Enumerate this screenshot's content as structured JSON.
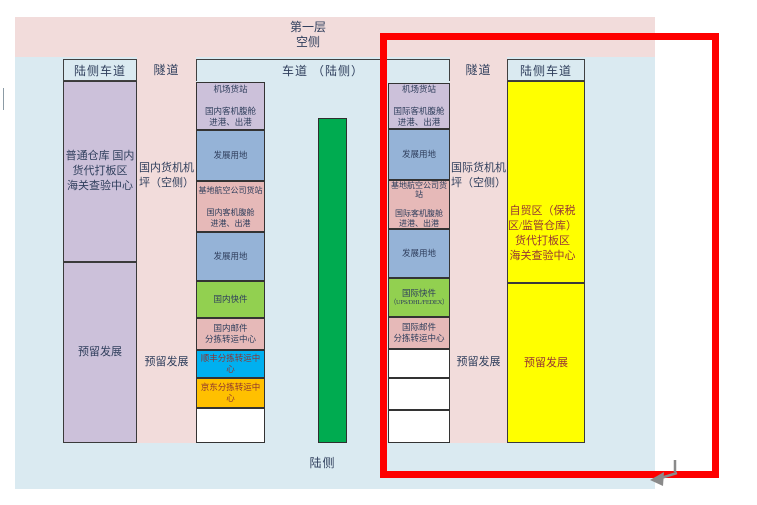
{
  "palette": {
    "banner_pink": "#F2DCDB",
    "bg_blue": "#DAEAF1",
    "highlight_red": "#FE0000",
    "green_bar": "#00AB50"
  },
  "title": "第一层\n空侧",
  "headers": {
    "left_lane": "陆侧车道",
    "tunnel_left": "隧道",
    "center_lane": "车道 （陆侧）",
    "tunnel_right": "隧道",
    "right_lane": "陆侧车道"
  },
  "bottom_label": "陆侧",
  "left_column": {
    "top": {
      "label": "普通仓库 国内\n货代打板区\n海关查验中心",
      "color": "#CCC1DA",
      "text_color": "#2F3E5C"
    },
    "bottom": {
      "label": "预留发展",
      "color": "#CCC1DA",
      "text_color": "#2F3E5C"
    }
  },
  "tunnel_left_zone": {
    "apron": "国内货机机\n坪（空侧）",
    "reserved": "预留发展"
  },
  "tunnel_right_zone": {
    "apron": "国际货机机\n坪（空侧）",
    "reserved": "预留发展"
  },
  "domestic_stack": {
    "blocks": [
      {
        "label": "机场货站\n\n国内客机腹舱\n进港、出港",
        "color": "#CCC1DA",
        "text_color": "#2F3E5C"
      },
      {
        "label": "发展用地",
        "color": "#95B3D7",
        "text_color": "#2F3E5C"
      },
      {
        "label": "基地航空公司货站\n\n国内客机腹舱\n进港、出港",
        "color": "#E6B9B8",
        "text_color": "#2F3E5C"
      },
      {
        "label": "发展用地",
        "color": "#95B3D7",
        "text_color": "#2F3E5C"
      },
      {
        "label": "国内快件",
        "color": "#92D050",
        "text_color": "#2F3E5C"
      },
      {
        "label": "国内邮件\n分拣转运中心",
        "color": "#E6B9B8",
        "text_color": "#2F3E5C"
      },
      {
        "label": "顺丰分拣转运中心",
        "color": "#00B0F0",
        "text_color": "#8D3430"
      },
      {
        "label": "京东分拣转运中心",
        "color": "#FFC000",
        "text_color": "#8D3430"
      },
      {
        "label": "",
        "color": "#FFFFFF",
        "text_color": "#2F3E5C"
      }
    ]
  },
  "intl_stack": {
    "blocks": [
      {
        "label": "机场货站\n\n国际客机腹舱\n进港、出港",
        "color": "#CCC1DA",
        "text_color": "#2F3E5C"
      },
      {
        "label": "发展用地",
        "color": "#95B3D7",
        "text_color": "#2F3E5C"
      },
      {
        "label": "基地航空公司货\n站\n\n国际客机腹舱\n进港、出港",
        "color": "#E6B9B8",
        "text_color": "#2F3E5C"
      },
      {
        "label": "发展用地",
        "color": "#95B3D7",
        "text_color": "#2F3E5C"
      },
      {
        "label": "国际快件",
        "sub": "（UPS/DHL/FEDEX）",
        "color": "#92D050",
        "text_color": "#2F3E5C"
      },
      {
        "label": "国际邮件\n分拣转运中心",
        "color": "#E6B9B8",
        "text_color": "#2F3E5C"
      },
      {
        "label": "",
        "color": "#FFFFFF",
        "text_color": "#2F3E5C"
      },
      {
        "label": "",
        "color": "#FFFFFF",
        "text_color": "#2F3E5C"
      },
      {
        "label": "",
        "color": "#FFFFFF",
        "text_color": "#2F3E5C"
      }
    ]
  },
  "right_column": {
    "top": {
      "label": "自贸区（保税\n区/监管仓库）\n货代打板区\n海关查验中心",
      "color": "#FFFF00",
      "text_color": "#963634"
    },
    "bottom": {
      "label": "预留发展",
      "color": "#FFFF00",
      "text_color": "#963634"
    }
  }
}
